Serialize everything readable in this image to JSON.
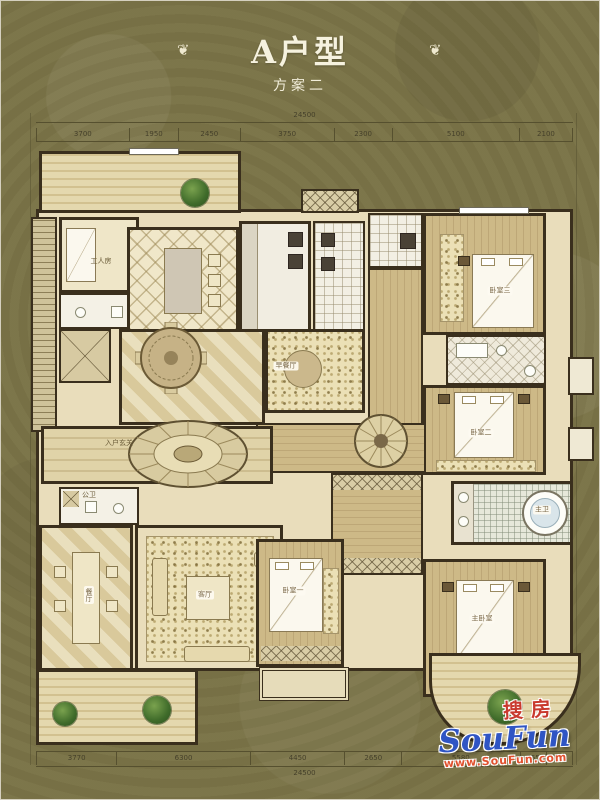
{
  "header": {
    "title": "A户型",
    "subtitle": "方案二",
    "ornament": "❦"
  },
  "dimensions": {
    "top_total": "24500",
    "top_segments": [
      "3700",
      "1950",
      "2450",
      "3750",
      "2300",
      "5100",
      "2100"
    ],
    "bottom_segments": [
      "3770",
      "6300",
      "4450",
      "2650",
      "5580",
      "955",
      "745"
    ],
    "bottom_total": "24500"
  },
  "rooms": {
    "entry_hall": "入户玄关",
    "maid_room": "工人房",
    "public_bath": "公卫",
    "breakfast": "早餐厅",
    "dining": "餐厅",
    "living": "客厅",
    "bedroom1": "卧室一",
    "bedroom2": "卧室二",
    "bedroom3": "卧室三",
    "master_bedroom": "主卧室",
    "master_bath": "主卫"
  },
  "watermark": {
    "cn": "搜房",
    "en": "SouFun",
    "url": "www.SouFun.com"
  },
  "colors": {
    "background": "#7a7347",
    "floor": "#e9ddbb",
    "wall": "#3a2f1d",
    "title_text": "#f6f2df",
    "watermark_red": "#c93a2e",
    "watermark_blue": "#2f55c4",
    "watermark_orange": "#e0512e"
  }
}
